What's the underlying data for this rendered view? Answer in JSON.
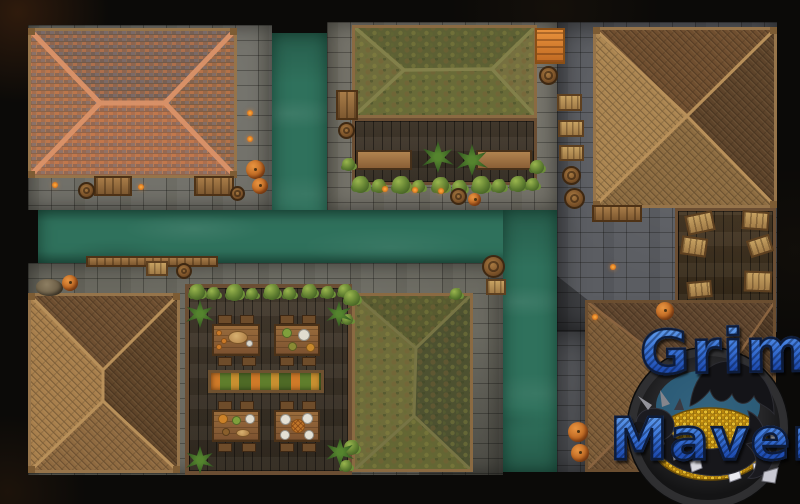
{
  "scene": {
    "type": "top-down fantasy village battle map with canals",
    "watermark": {
      "line1": "Grim",
      "line2": "Maven"
    },
    "palette": {
      "background_void": "#0b0a08",
      "canal_water": "#2f715c",
      "pavement": "#6b6a62",
      "pavement_dark": "#54565b",
      "deck_planks": "#3f3528",
      "wood_frame": "#6b4e33",
      "roof_terracotta": "#c28156",
      "roof_terracotta_ridge": "#db9268",
      "roof_shingle_light": "#ab8551",
      "roof_shingle_dark": "#5d432a",
      "roof_moss_green": "#6e6c3a",
      "ivy_green": "#5d7c2f",
      "crate_wood": "#c7a262",
      "barrel_wood": "#7a5128",
      "pumpkin": "#c06a24",
      "logo_letter_blue": "#3a74d8",
      "logo_outline": "#0e1c3a",
      "logo_gold": "#d9a81e",
      "logo_dragon": "#17171b"
    },
    "landmarks": [
      {
        "id": "terracotta-roof-house",
        "label": "terracotta-roofed house north-west"
      },
      {
        "id": "moss-roof-tavern",
        "label": "moss-roofed open tavern north-center"
      },
      {
        "id": "shingle-house-north-east",
        "label": "wood-shingled house north-east"
      },
      {
        "id": "shingle-house-south-west",
        "label": "wood-shingled house south-west"
      },
      {
        "id": "market-deck",
        "label": "market deck with tables and planter"
      },
      {
        "id": "moss-roof-house-south",
        "label": "moss-roofed house south-center"
      },
      {
        "id": "crate-warehouse",
        "label": "open warehouse with crates east"
      },
      {
        "id": "shingle-house-south-east",
        "label": "wood-shingled house south-east"
      },
      {
        "id": "canal",
        "label": "teal canal running through district"
      }
    ]
  }
}
